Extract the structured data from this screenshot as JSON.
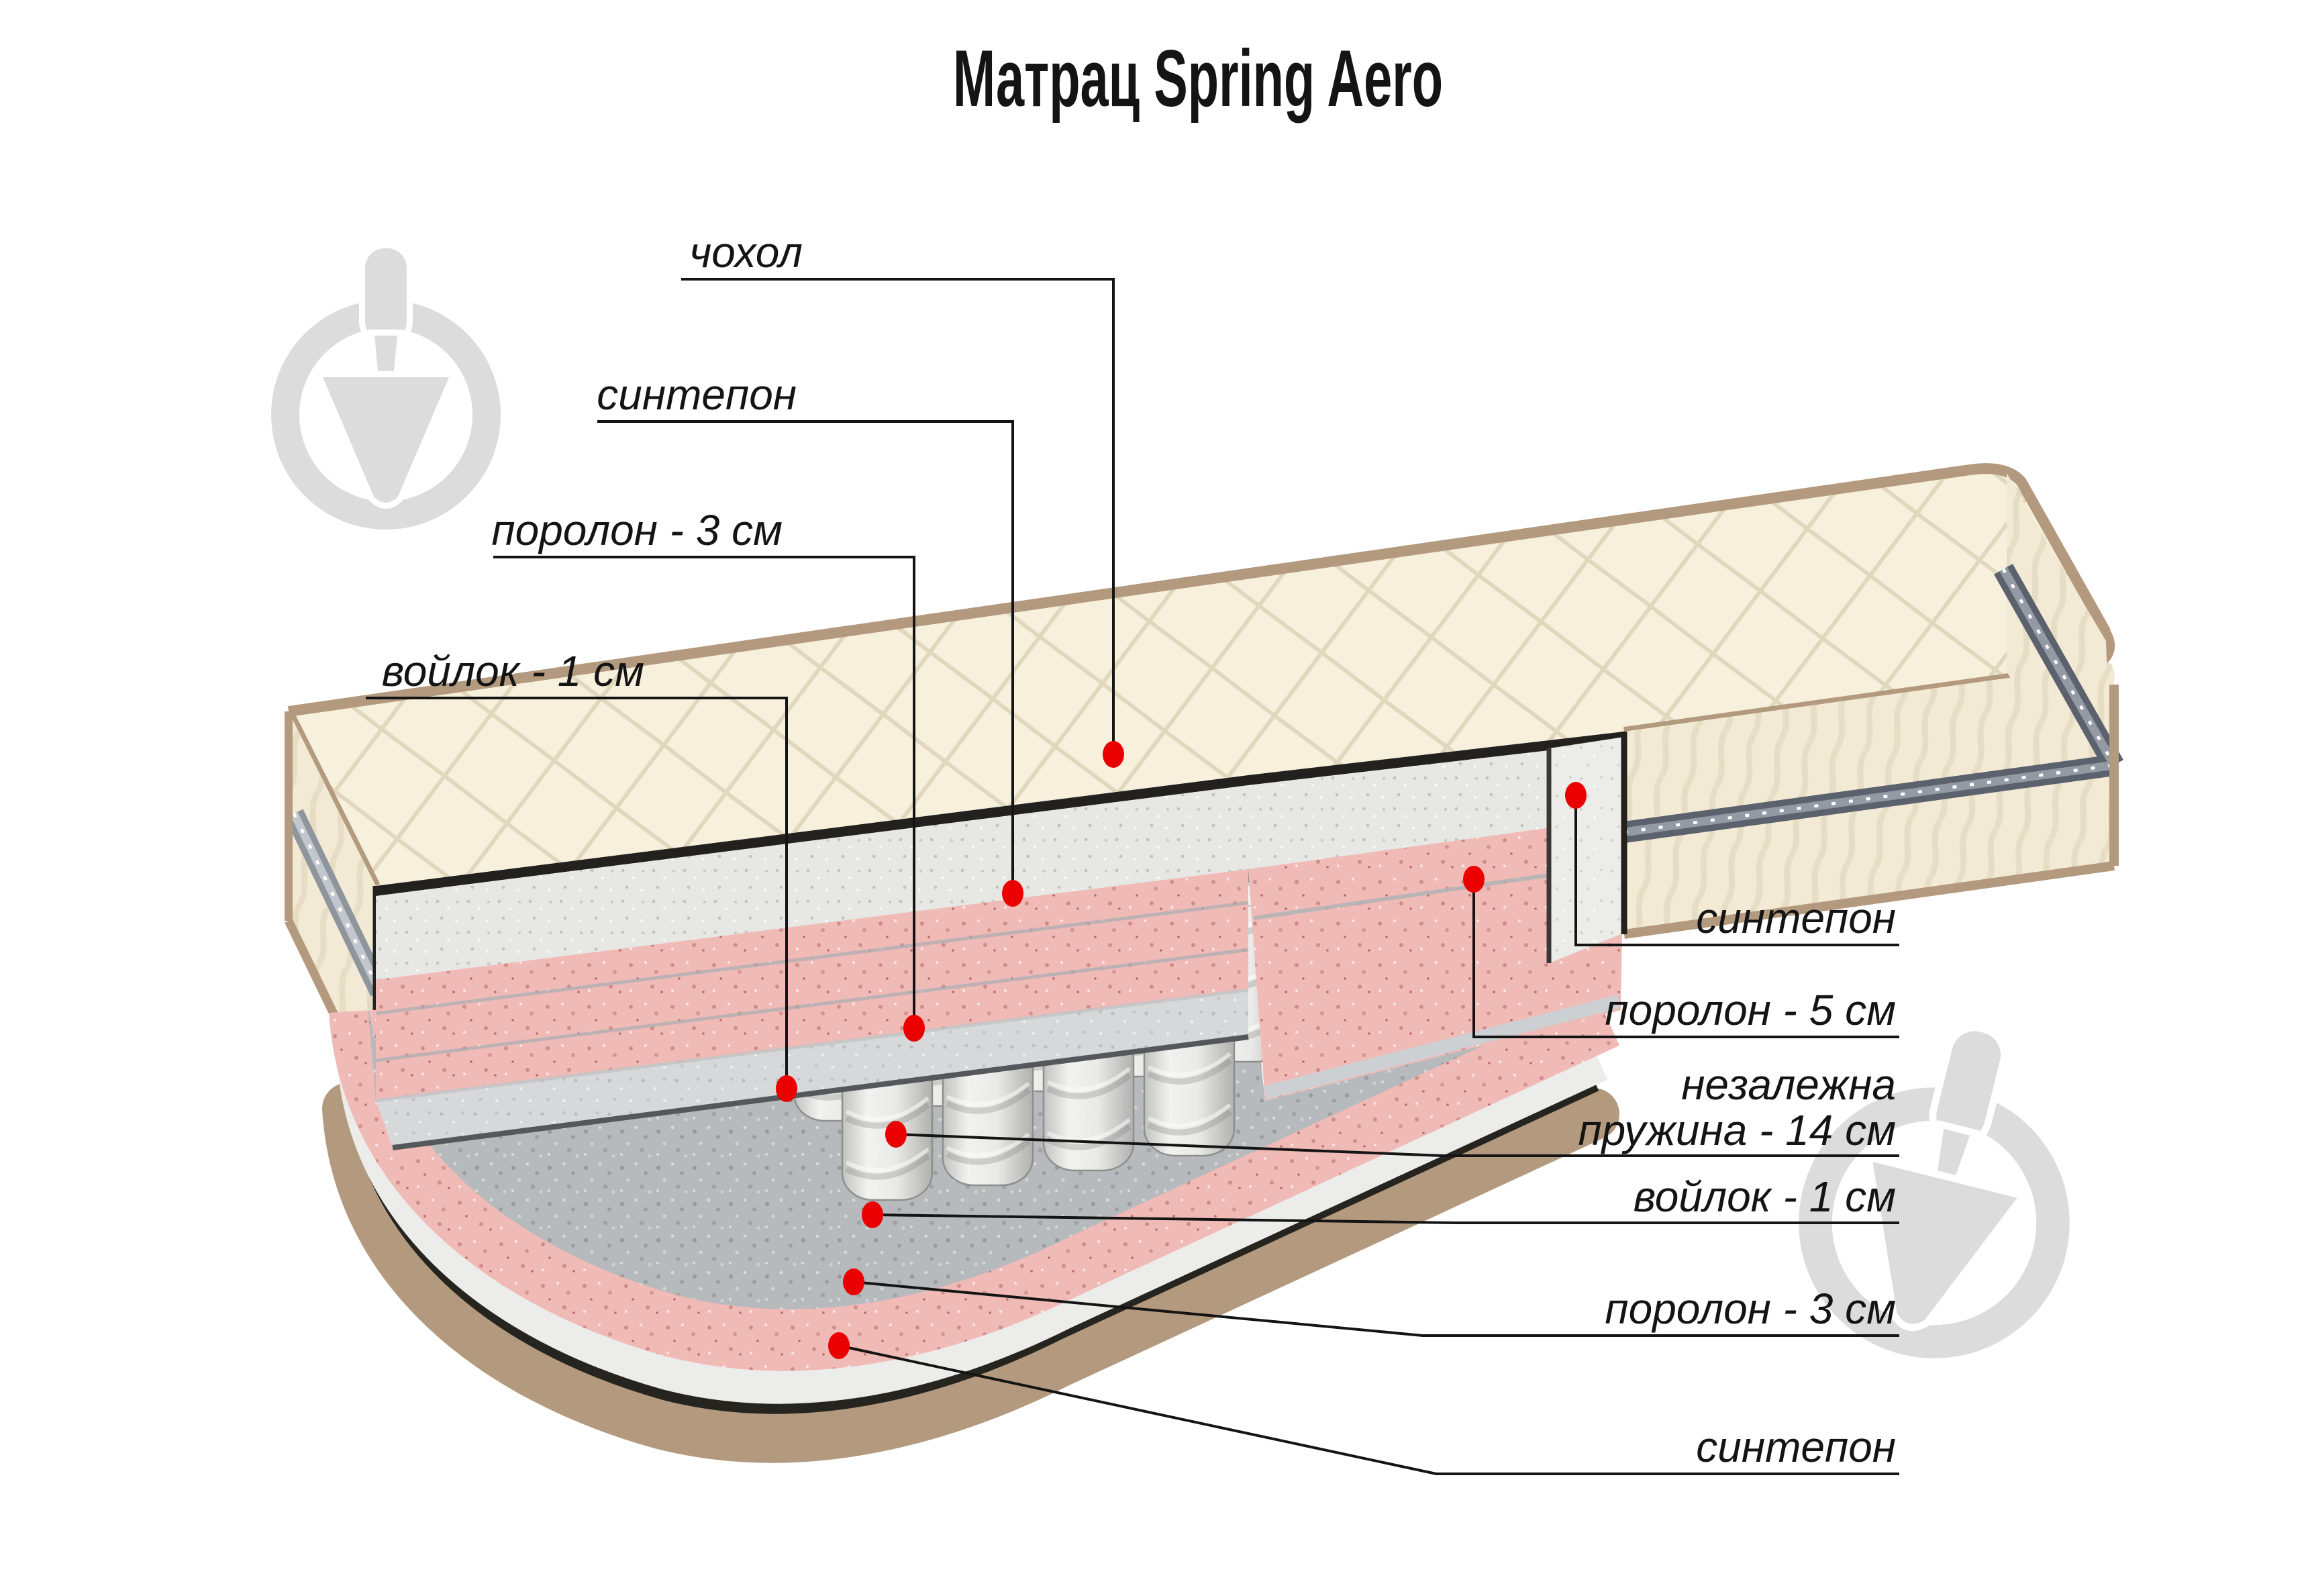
{
  "title": "Матрац Spring Aero",
  "diagram": {
    "subject": "mattress-cutaway",
    "labels_left": [
      {
        "text": "чохол"
      },
      {
        "text": "синтепон"
      },
      {
        "text": "поролон - 3 см"
      },
      {
        "text": "войлок - 1 см"
      }
    ],
    "labels_right": [
      {
        "text": "синтепон"
      },
      {
        "text": "поролон - 5 см"
      },
      {
        "line1": "незалежна",
        "line2": "пружина - 14 см"
      },
      {
        "text": "войлок - 1 см"
      },
      {
        "text": "поролон - 3 см"
      },
      {
        "text": "синтепон"
      }
    ],
    "callout_count": 10,
    "watermark": "trowel-logo-watermark"
  },
  "colors": {
    "callout_dot": "#ea0000",
    "leader_line": "#141414",
    "quilt_cream": "#f7f0dd",
    "side_cream": "#f2ead4",
    "piping_tan": "#b3997d",
    "zipper_grey": "#5b616d",
    "foam_pink": "#f0bab6",
    "felt_grey": "#b7babc",
    "sintepon_grey": "#e7e7e4",
    "spring_grey": "#d9d9d7",
    "watermark_grey": "#dcdcdc",
    "background": "#ffffff"
  }
}
